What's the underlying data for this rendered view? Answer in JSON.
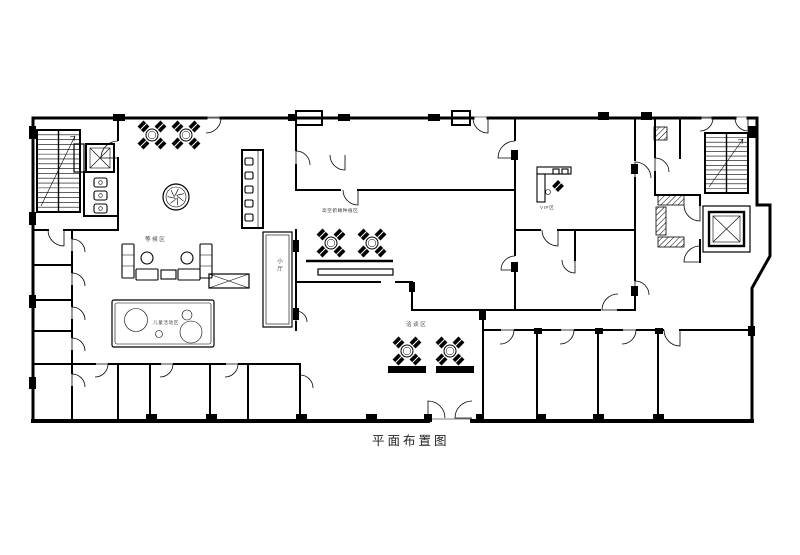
{
  "drawing": {
    "title": "平面布置图",
    "labels": {
      "waiting_area": "等候区",
      "aerial_zone": "高空俯瞰种植区",
      "vip_zone": "VIP区",
      "small_hall": "小厅",
      "negotiation_zone": "洽谈区",
      "kids_zone": "儿童活动区"
    },
    "colors": {
      "ink": "#000000",
      "paper": "#ffffff"
    }
  }
}
